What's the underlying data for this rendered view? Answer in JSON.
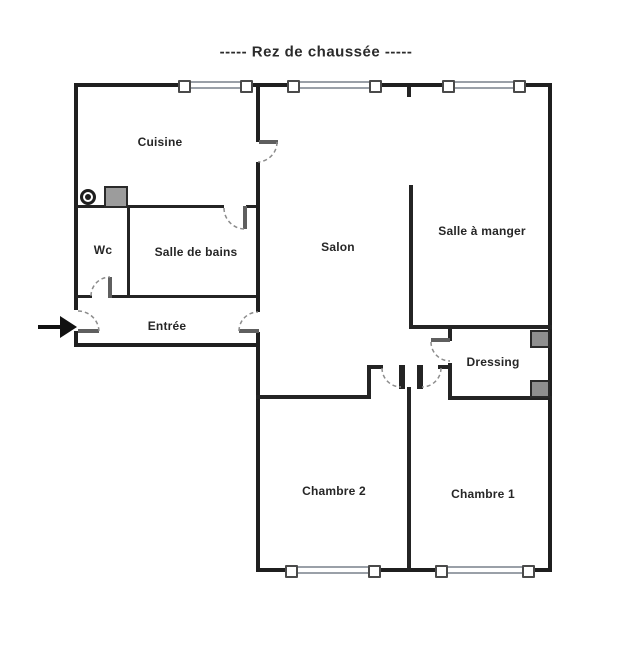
{
  "title": "-----  Rez de chaussée  -----",
  "rooms": {
    "cuisine": "Cuisine",
    "wc": "Wc",
    "salle_de_bains": "Salle de bains",
    "salon": "Salon",
    "salle_a_manger": "Salle à manger",
    "entree": "Entrée",
    "dressing": "Dressing",
    "chambre2": "Chambre 2",
    "chambre1": "Chambre 1"
  },
  "icons": {
    "entrance_arrow": "right-arrow",
    "boiler": "circle-with-dot",
    "flue": "gray-square-block",
    "radiator": "gray-rectangle",
    "window": "double-rail-with-end-squares",
    "door": "quarter-circle-dashed-swing"
  },
  "colors": {
    "wall": "#1f1f1f",
    "window_rail": "#9aa0a8",
    "door_leaf": "#5f5f5f",
    "door_arc": "#8c8c8c",
    "fixture_fill": "#9c9c9c",
    "text": "#262626",
    "background": "#ffffff"
  }
}
